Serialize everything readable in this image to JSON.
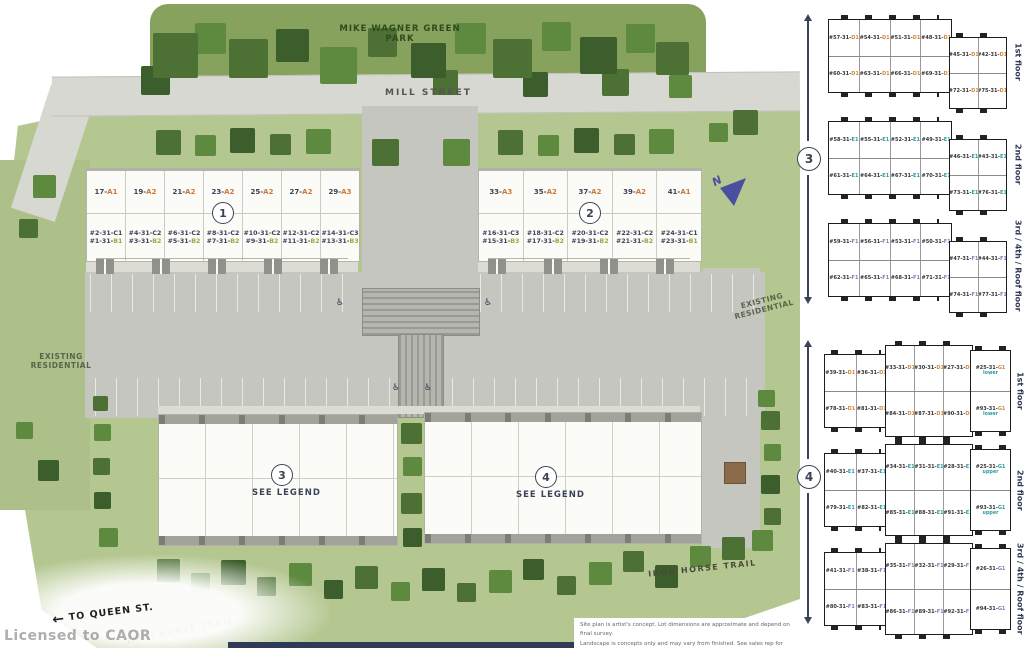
{
  "site": {
    "park_label": "MIKE WAGNER GREEN\nPARK",
    "street_label": "MILL STREET",
    "existing_residential_left": "EXISTING\nRESIDENTIAL",
    "existing_residential_right": "EXISTING\nRESIDENTIAL",
    "iron_horse_trail_right": "IRON HORSE TRAIL",
    "iron_horse_trail_left": "IRON HORSE TRAIL",
    "to_queen_st": "TO QUEEN ST.",
    "queen_arrow": "←",
    "licensed": "Licensed to CAOR",
    "north_label": "N",
    "accessible_icon": "♿",
    "disclaimer_line1": "Site plan is artist's concept. Lot dimensions are approximate and depend on final survey.",
    "disclaimer_line2": "Landscape is concepts only and may vary from finished. See sales rep for details E. & O. E."
  },
  "building1": {
    "number": "1",
    "units": [
      {
        "lot": "17-",
        "lot_type": "A1",
        "c": "#2-31-C1",
        "b": "#1-31-",
        "b_type": "B1"
      },
      {
        "lot": "19-",
        "lot_type": "A2",
        "c": "#4-31-C2",
        "b": "#3-31-",
        "b_type": "B2"
      },
      {
        "lot": "21-",
        "lot_type": "A2",
        "c": "#6-31-C2",
        "b": "#5-31-",
        "b_type": "B2"
      },
      {
        "lot": "23-",
        "lot_type": "A2",
        "c": "#8-31-C2",
        "b": "#7-31-",
        "b_type": "B2"
      },
      {
        "lot": "25-",
        "lot_type": "A2",
        "c": "#10-31-C2",
        "b": "#9-31-",
        "b_type": "B2"
      },
      {
        "lot": "27-",
        "lot_type": "A2",
        "c": "#12-31-C2",
        "b": "#11-31-",
        "b_type": "B2"
      },
      {
        "lot": "29-",
        "lot_type": "A3",
        "c": "#14-31-C3",
        "b": "#13-31-",
        "b_type": "B3"
      }
    ]
  },
  "building2": {
    "number": "2",
    "units": [
      {
        "lot": "33-",
        "lot_type": "A3",
        "c": "#16-31-C3",
        "b": "#15-31-",
        "b_type": "B3"
      },
      {
        "lot": "35-",
        "lot_type": "A2",
        "c": "#18-31-C2",
        "b": "#17-31-",
        "b_type": "B2"
      },
      {
        "lot": "37-",
        "lot_type": "A2",
        "c": "#20-31-C2",
        "b": "#19-31-",
        "b_type": "B2"
      },
      {
        "lot": "39-",
        "lot_type": "A2",
        "c": "#22-31-C2",
        "b": "#21-31-",
        "b_type": "B2"
      },
      {
        "lot": "41-",
        "lot_type": "A1",
        "c": "#24-31-C1",
        "b": "#23-31-",
        "b_type": "B1"
      }
    ]
  },
  "building3": {
    "number": "3",
    "legend": "SEE LEGEND"
  },
  "building4": {
    "number": "4",
    "legend": "SEE LEGEND"
  },
  "floorplans": {
    "group3": {
      "number": "3",
      "floors": [
        {
          "label": "1st floor",
          "accent": "D",
          "main_top": [
            {
              "n": "#57-31-",
              "t": "D1"
            },
            {
              "n": "#54-31-",
              "t": "D1"
            },
            {
              "n": "#51-31-",
              "t": "D1"
            },
            {
              "n": "#48-31-",
              "t": "D1"
            }
          ],
          "main_bottom": [
            {
              "n": "#60-31-",
              "t": "D1"
            },
            {
              "n": "#63-31-",
              "t": "D1"
            },
            {
              "n": "#66-31-",
              "t": "D1"
            },
            {
              "n": "#69-31-",
              "t": "D1"
            }
          ],
          "annex_top": [
            {
              "n": "#45-31-",
              "t": "D1"
            },
            {
              "n": "#42-31-",
              "t": "D1"
            }
          ],
          "annex_bottom": [
            {
              "n": "#72-31-",
              "t": "D1"
            },
            {
              "n": "#75-31-",
              "t": "D1"
            }
          ]
        },
        {
          "label": "2nd floor",
          "accent": "E",
          "main_top": [
            {
              "n": "#58-31-",
              "t": "E1"
            },
            {
              "n": "#55-31-",
              "t": "E1"
            },
            {
              "n": "#52-31-",
              "t": "E1"
            },
            {
              "n": "#49-31-",
              "t": "E1"
            }
          ],
          "main_bottom": [
            {
              "n": "#61-31-",
              "t": "E1"
            },
            {
              "n": "#64-31-",
              "t": "E1"
            },
            {
              "n": "#67-31-",
              "t": "E1"
            },
            {
              "n": "#70-31-",
              "t": "E1"
            }
          ],
          "annex_top": [
            {
              "n": "#46-31-",
              "t": "E1"
            },
            {
              "n": "#43-31-",
              "t": "E1"
            }
          ],
          "annex_bottom": [
            {
              "n": "#73-31-",
              "t": "E1"
            },
            {
              "n": "#76-31-",
              "t": "E1"
            }
          ]
        },
        {
          "label": "3rd / 4th / Roof floor",
          "accent": "F",
          "main_top": [
            {
              "n": "#59-31-",
              "t": "F1"
            },
            {
              "n": "#56-31-",
              "t": "F1"
            },
            {
              "n": "#53-31-",
              "t": "F1"
            },
            {
              "n": "#50-31-",
              "t": "F1"
            }
          ],
          "main_bottom": [
            {
              "n": "#62-31-",
              "t": "F1"
            },
            {
              "n": "#65-31-",
              "t": "F1"
            },
            {
              "n": "#68-31-",
              "t": "F1"
            },
            {
              "n": "#71-31-",
              "t": "F1"
            }
          ],
          "annex_top": [
            {
              "n": "#47-31-",
              "t": "F1"
            },
            {
              "n": "#44-31-",
              "t": "F1"
            }
          ],
          "annex_bottom": [
            {
              "n": "#74-31-",
              "t": "F1"
            },
            {
              "n": "#77-31-",
              "t": "F1"
            }
          ]
        }
      ]
    },
    "group4": {
      "number": "4",
      "floors": [
        {
          "label": "1st floor",
          "accent": "D",
          "left_top": [
            {
              "n": "#39-31-",
              "t": "D1"
            },
            {
              "n": "#36-31-",
              "t": "D1"
            }
          ],
          "left_bottom": [
            {
              "n": "#78-31-",
              "t": "D1"
            },
            {
              "n": "#81-31-",
              "t": "D1"
            }
          ],
          "mid_top": [
            {
              "n": "#33-31-",
              "t": "D1"
            },
            {
              "n": "#30-31-",
              "t": "D1"
            },
            {
              "n": "#27-31-",
              "t": "D1"
            }
          ],
          "mid_bottom": [
            {
              "n": "#84-31-",
              "t": "D1"
            },
            {
              "n": "#87-31-",
              "t": "D1"
            },
            {
              "n": "#90-31-",
              "t": "D1"
            }
          ],
          "right": [
            {
              "n": "#25-31-",
              "t": "G1",
              "sub": "lower"
            },
            {
              "n": "#93-31-",
              "t": "G1",
              "sub": "lower"
            }
          ]
        },
        {
          "label": "2nd floor",
          "accent": "E",
          "left_top": [
            {
              "n": "#40-31-",
              "t": "E1"
            },
            {
              "n": "#37-31-",
              "t": "E1"
            }
          ],
          "left_bottom": [
            {
              "n": "#79-31-",
              "t": "E1"
            },
            {
              "n": "#82-31-",
              "t": "E1"
            }
          ],
          "mid_top": [
            {
              "n": "#34-31-",
              "t": "E1"
            },
            {
              "n": "#31-31-",
              "t": "E1"
            },
            {
              "n": "#28-31-",
              "t": "E1"
            }
          ],
          "mid_bottom": [
            {
              "n": "#85-31-",
              "t": "E1"
            },
            {
              "n": "#88-31-",
              "t": "E1"
            },
            {
              "n": "#91-31-",
              "t": "E1"
            }
          ],
          "right": [
            {
              "n": "#25-31-",
              "t": "G1",
              "sub": "upper"
            },
            {
              "n": "#93-31-",
              "t": "G1",
              "sub": "upper"
            }
          ]
        },
        {
          "label": "3rd / 4th / Roof floor",
          "accent": "F",
          "left_top": [
            {
              "n": "#41-31-",
              "t": "F1"
            },
            {
              "n": "#38-31-",
              "t": "F1"
            }
          ],
          "left_bottom": [
            {
              "n": "#80-31-",
              "t": "F1"
            },
            {
              "n": "#83-31-",
              "t": "F1"
            }
          ],
          "mid_top": [
            {
              "n": "#35-31-",
              "t": "F1"
            },
            {
              "n": "#32-31-",
              "t": "F1"
            },
            {
              "n": "#29-31-",
              "t": "F1"
            }
          ],
          "mid_bottom": [
            {
              "n": "#86-31-",
              "t": "F1"
            },
            {
              "n": "#89-31-",
              "t": "F1"
            },
            {
              "n": "#92-31-",
              "t": "F1"
            }
          ],
          "right": [
            {
              "n": "#26-31-",
              "t": "G1",
              "sub": ""
            },
            {
              "n": "#94-31-",
              "t": "G1",
              "sub": ""
            }
          ]
        }
      ]
    }
  },
  "colors": {
    "site_green": "#b5c791",
    "tree_dark": "#3c5e2c",
    "tree_mid": "#4d7134",
    "tree_light": "#5e8a40",
    "road_gray": "#d8d8d3",
    "parking_gray": "#c6c6c0",
    "navy_text": "#3c4257",
    "lot_type_orange": "#d0763b",
    "b_type_olive": "#9fa73f",
    "accent_d": "#d08a3e",
    "accent_e": "#2f9aa0",
    "accent_f": "#9277b8",
    "footer_navy": "#2e3a56"
  }
}
